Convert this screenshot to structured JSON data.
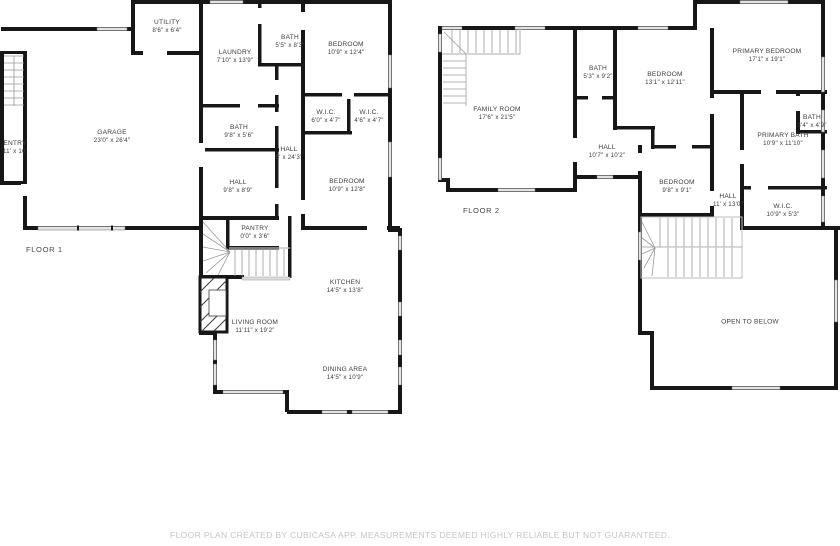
{
  "caption": "FLOOR PLAN CREATED BY CUBICASA APP. MEASUREMENTS DEEMED HIGHLY RELIABLE BUT NOT GUARANTEED.",
  "colors": {
    "wall": "#171717",
    "window_fill": "#e3e3e3",
    "label_text": "#3d3d3d",
    "caption_text": "#c6c6c6"
  },
  "floors": [
    {
      "label": "FLOOR 1",
      "label_pos": [
        26,
        249
      ],
      "rooms": [
        {
          "name": "UTILITY",
          "dims": "8'6\" x 6'4\"",
          "pos": [
            167,
            27
          ]
        },
        {
          "name": "LAUNDRY",
          "dims": "7'10\" x 13'9\"",
          "pos": [
            235,
            57
          ]
        },
        {
          "name": "BATH",
          "dims": "5'5\" x 8'3\"",
          "pos": [
            290,
            42
          ]
        },
        {
          "name": "BEDROOM",
          "dims": "10'9\" x 12'4\"",
          "pos": [
            346,
            49
          ]
        },
        {
          "name": "W.I.C.",
          "dims": "6'0\" x 4'7\"",
          "pos": [
            326,
            117
          ]
        },
        {
          "name": "W.I.C.",
          "dims": "4'6\" x 4'7\"",
          "pos": [
            369,
            117
          ]
        },
        {
          "name": "GARAGE",
          "dims": "23'0\" x 26'4\"",
          "pos": [
            112,
            137
          ]
        },
        {
          "name": "ENTRY",
          "dims": "11' x 10'",
          "pos": [
            15,
            148
          ]
        },
        {
          "name": "BATH",
          "dims": "9'8\" x 5'6\"",
          "pos": [
            239,
            132
          ]
        },
        {
          "name": "HALL",
          "dims": "5' x 24'3\"",
          "pos": [
            289,
            154
          ]
        },
        {
          "name": "HALL",
          "dims": "9'8\" x 8'9\"",
          "pos": [
            238,
            187
          ]
        },
        {
          "name": "BEDROOM",
          "dims": "10'9\" x 12'8\"",
          "pos": [
            347,
            186
          ]
        },
        {
          "name": "PANTRY",
          "dims": "0'0\" x 3'6\"",
          "pos": [
            255,
            233
          ]
        },
        {
          "name": "KITCHEN",
          "dims": "14'5\" x 13'8\"",
          "pos": [
            345,
            287
          ]
        },
        {
          "name": "LIVING ROOM",
          "dims": "11'11\" x 19'2\"",
          "pos": [
            255,
            327
          ]
        },
        {
          "name": "DINING AREA",
          "dims": "14'5\" x 10'9\"",
          "pos": [
            345,
            374
          ]
        }
      ]
    },
    {
      "label": "FLOOR 2",
      "label_pos": [
        463,
        210
      ],
      "rooms": [
        {
          "name": "FAMILY ROOM",
          "dims": "17'6\" x 21'5\"",
          "pos": [
            497,
            114
          ]
        },
        {
          "name": "BATH",
          "dims": "5'3\" x 9'2\"",
          "pos": [
            598,
            73
          ]
        },
        {
          "name": "BEDROOM",
          "dims": "13'1\" x 12'11\"",
          "pos": [
            665,
            79
          ]
        },
        {
          "name": "PRIMARY BEDROOM",
          "dims": "17'1\" x 19'1\"",
          "pos": [
            767,
            56
          ]
        },
        {
          "name": "BATH",
          "dims": "3'4\" x 4'9\"",
          "pos": [
            812,
            122
          ]
        },
        {
          "name": "PRIMARY BATH",
          "dims": "10'9\" x 11'10\"",
          "pos": [
            783,
            140
          ]
        },
        {
          "name": "HALL",
          "dims": "10'7\" x 10'2\"",
          "pos": [
            607,
            152
          ]
        },
        {
          "name": "BEDROOM",
          "dims": "9'8\" x 9'1\"",
          "pos": [
            677,
            187
          ]
        },
        {
          "name": "HALL",
          "dims": "11' x 13'0\"",
          "pos": [
            728,
            201
          ]
        },
        {
          "name": "W.I.C.",
          "dims": "10'9\" x 5'3\"",
          "pos": [
            783,
            211
          ]
        },
        {
          "name": "OPEN TO BELOW",
          "dims": "",
          "pos": [
            750,
            322
          ]
        }
      ]
    }
  ]
}
